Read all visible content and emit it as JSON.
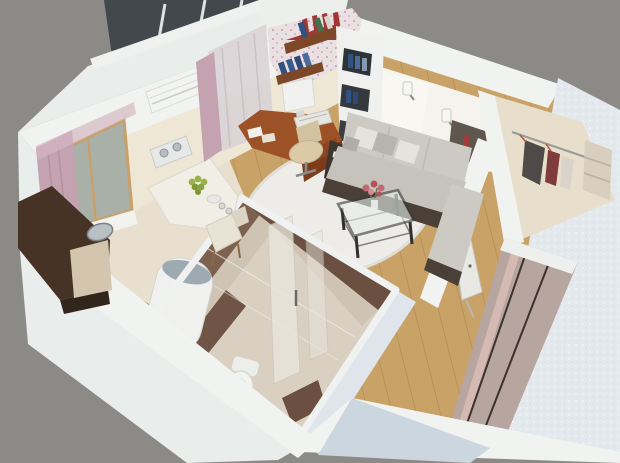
{
  "scene": {
    "type": "3d-apartment-cutaway-render",
    "description": "Isometric 3D cutaway rendering of a small studio apartment viewed from above, on a plain gray backdrop",
    "rooms": [
      "balcony",
      "kitchen",
      "bathroom",
      "living-room",
      "hallway",
      "walk-in-closet"
    ],
    "objects": [
      "balcony-glazing",
      "air-conditioner",
      "kitchen-window-with-pink-curtains",
      "wall-spotlights",
      "kitchen-counter-with-sink",
      "white-bar-table-with-grapes",
      "wooden-chair",
      "corner-computer-desk",
      "monitor",
      "keyboard",
      "office-chair",
      "wall-book-shelves",
      "built-in-white-bookshelf",
      "floral-wallpaper",
      "l-shaped-sofa",
      "throw-pillows",
      "wall-sconces",
      "glass-coffee-table-with-flowers",
      "round-white-rug",
      "wood-laminate-floor",
      "washing-machine",
      "toilet",
      "glass-shower-screen",
      "brown-tiled-bathroom-walls",
      "wardrobe-with-mirror-doors",
      "clothes-rail-with-hangers",
      "ironing-board",
      "textured-exterior-wall"
    ]
  },
  "palette": {
    "background": "#8b8a87",
    "wallTop": "#f1f3f1",
    "wallFace": "#e9edec",
    "wallShadow": "#ccd6de",
    "wallBlue": "#dfe5ea",
    "innerWallCream": "#efe7d6",
    "kitchenFloor": "#e9dfcf",
    "woodFloor": "#c9a268",
    "woodLine": "#a8834e",
    "rug": "#edece8",
    "tileBrownDark": "#6b4f40",
    "tileBrownLight": "#7d614f",
    "bathWallLower": "#cfc3b3",
    "bathFloor": "#d9d0c2",
    "counter": "#463326",
    "counterFront": "#32251b",
    "counterBeige": "#d4c6ae",
    "deskWood": "#9c5226",
    "deskFront": "#7c3c1c",
    "shelfWood": "#7c4828",
    "sofaCushion": "#cdc9c3",
    "sofaSeat": "#c6c3bc",
    "sofaBase": "#4a4038",
    "pillowLight": "#e5e3de",
    "pillowDark": "#b7b4ad",
    "curtainPink": "#c4a2b0",
    "curtainSheer": "#d9d3d6",
    "balconyGlass": "#43484d",
    "grapes": "#9ab14c",
    "bookRed": "#a23636",
    "bookBlue": "#31517e",
    "bookGreen": "#47704c",
    "appliance": "#f0f1ef",
    "washerLid": "#9daab2",
    "mirror": "#b7a5a0",
    "mirrorGlow": "#dabdb7",
    "clothesDark": "#4e4a48",
    "clothesMaroon": "#7e3c3c",
    "clothesLight": "#d9d3c9",
    "flower": "#c16a74",
    "textureWall": "#e4e9ed",
    "glassShower": "#e9e6dd",
    "closetWall": "#e7decb",
    "glossyWall": "#f4f3ee",
    "niche": "#5f574e"
  }
}
